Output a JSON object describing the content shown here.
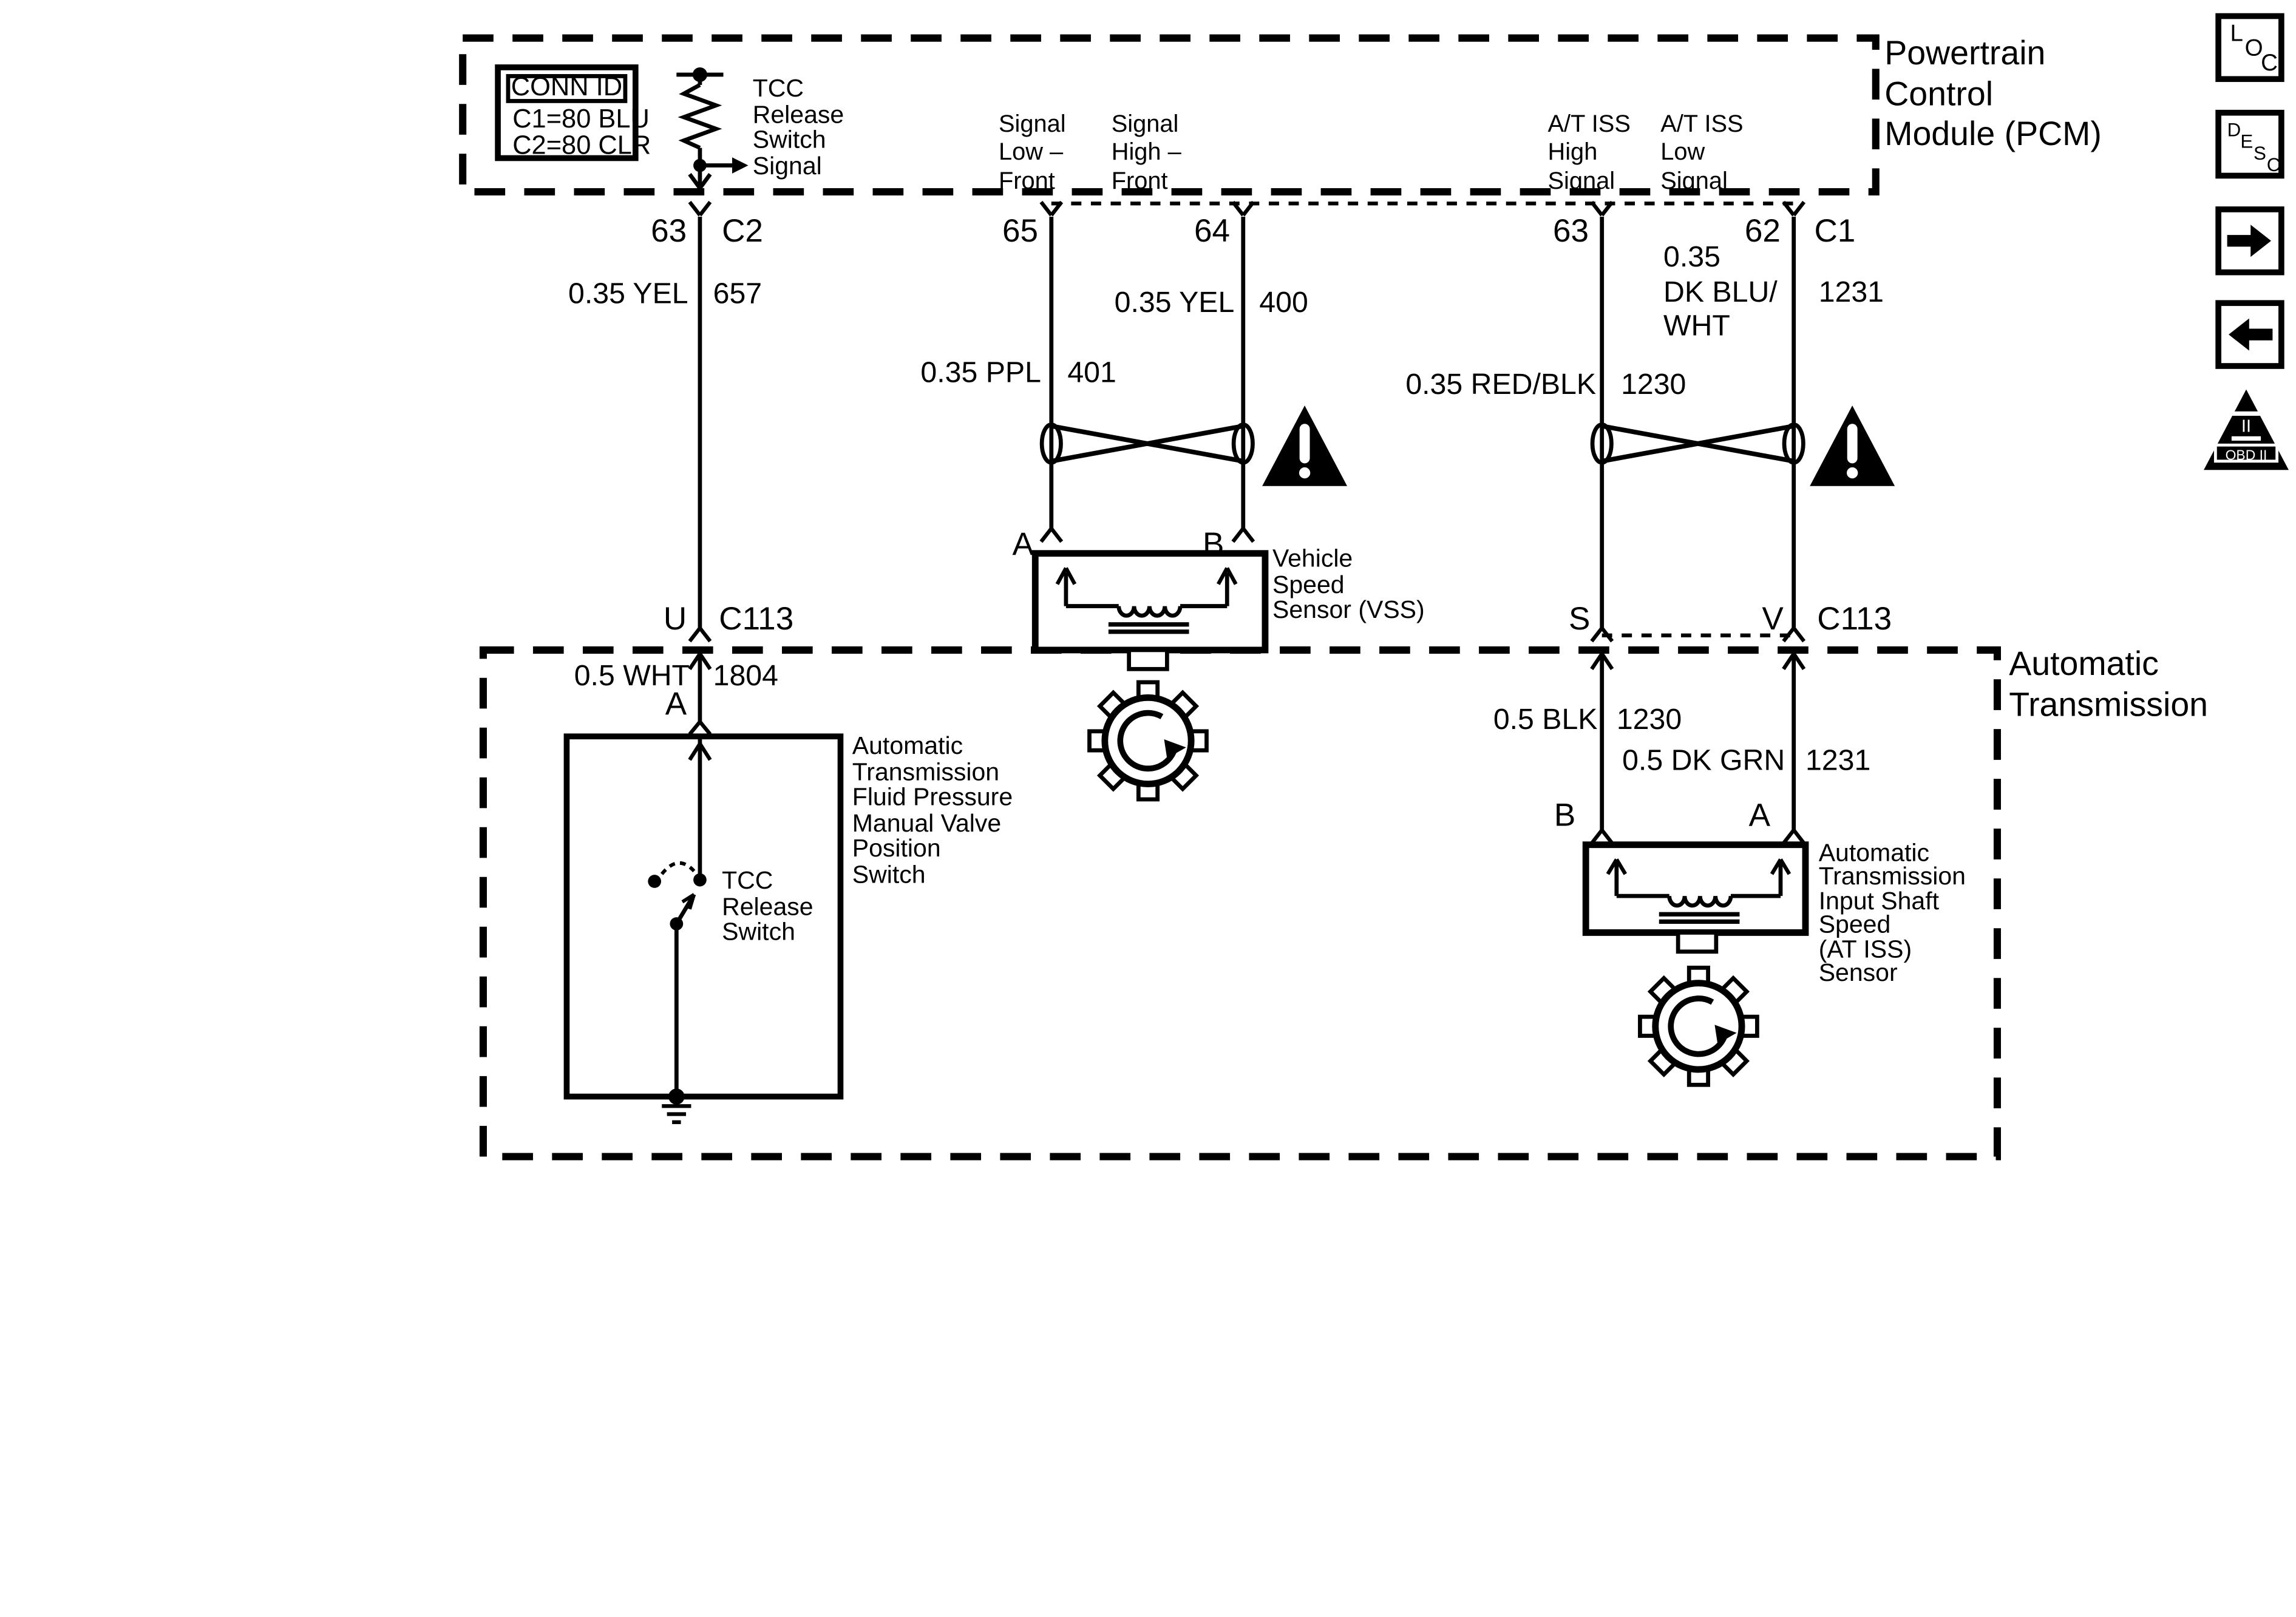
{
  "pcm": {
    "title": [
      "Powertrain",
      "Control",
      "Module (PCM)"
    ]
  },
  "transmission": {
    "title": [
      "Automatic",
      "Transmission"
    ]
  },
  "conn_id": {
    "header": "CONN ID",
    "rows": [
      "C1=80 BLU",
      "C2=80 CLR"
    ]
  },
  "pcm_pins": {
    "tcc_signal": {
      "lines": [
        "TCC",
        "Release",
        "Switch",
        "Signal"
      ],
      "pin": "63",
      "connector": "C2"
    },
    "signal_low": {
      "lines": [
        "Signal",
        "Low –",
        "Front"
      ],
      "pin": "65"
    },
    "signal_high": {
      "lines": [
        "Signal",
        "High –",
        "Front"
      ],
      "pin": "64"
    },
    "iss_high": {
      "lines": [
        "A/T ISS",
        "High",
        "Signal"
      ],
      "pin": "63"
    },
    "iss_low": {
      "lines": [
        "A/T ISS",
        "Low",
        "Signal"
      ],
      "pin": "62",
      "connector": "C1"
    }
  },
  "wires": {
    "yel_657": {
      "label": "0.35 YEL",
      "circuit": "657"
    },
    "ppl_401": {
      "label": "0.35 PPL",
      "circuit": "401"
    },
    "yel_400": {
      "label": "0.35 YEL",
      "circuit": "400"
    },
    "redblk_1230": {
      "label": "0.35 RED/BLK",
      "circuit": "1230"
    },
    "dkblu_1231": {
      "lines": [
        "0.35",
        "DK BLU/",
        "WHT"
      ],
      "circuit": "1231"
    },
    "wht_1804": {
      "label": "0.5 WHT",
      "circuit": "1804"
    },
    "blk_1230": {
      "label": "0.5 BLK",
      "circuit": "1230"
    },
    "dkgrn_1231": {
      "label": "0.5 DK GRN",
      "circuit": "1231"
    }
  },
  "c113_left": {
    "pcm_pin": "U",
    "label": "C113",
    "trans_pin": "A"
  },
  "c113_right": {
    "pin_s": "S",
    "pin_v": "V",
    "label": "C113",
    "trans_pin_b": "B",
    "trans_pin_a": "A"
  },
  "vss": {
    "pin_a": "A",
    "pin_b": "B",
    "label": [
      "Vehicle",
      "Speed",
      "Sensor (VSS)"
    ]
  },
  "tcc_switch": {
    "label": [
      "TCC",
      "Release",
      "Switch"
    ]
  },
  "fpmvps": {
    "label": [
      "Automatic",
      "Transmission",
      "Fluid Pressure",
      "Manual Valve",
      "Position",
      "Switch"
    ]
  },
  "iss_sensor": {
    "label": [
      "Automatic",
      "Transmission",
      "Input Shaft",
      "Speed",
      "(AT ISS)",
      "Sensor"
    ]
  },
  "nav": {
    "loc": [
      "L",
      "O",
      "C"
    ],
    "desc": [
      "D",
      "E",
      "S",
      "C"
    ],
    "obd_numeral": "II",
    "obd_label": "OBD II"
  }
}
